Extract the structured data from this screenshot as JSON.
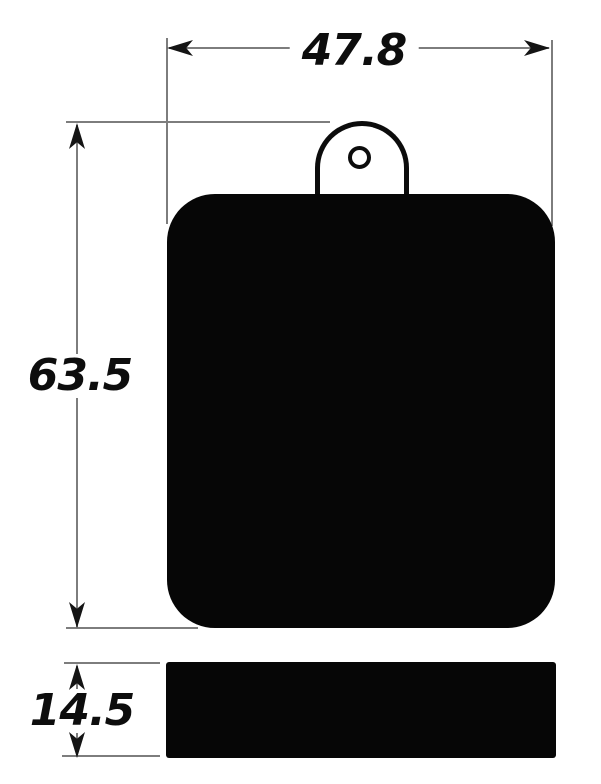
{
  "drawing": {
    "kind": "technical dimension drawing",
    "background": "#ffffff",
    "ink_color": "#0d0d0d",
    "line_color": "#7d7d7d",
    "part_fill_color": "#060606",
    "dimensions": {
      "width": {
        "label": "47.8"
      },
      "height": {
        "label": "63.5"
      },
      "thickness": {
        "label": "14.5"
      }
    }
  }
}
